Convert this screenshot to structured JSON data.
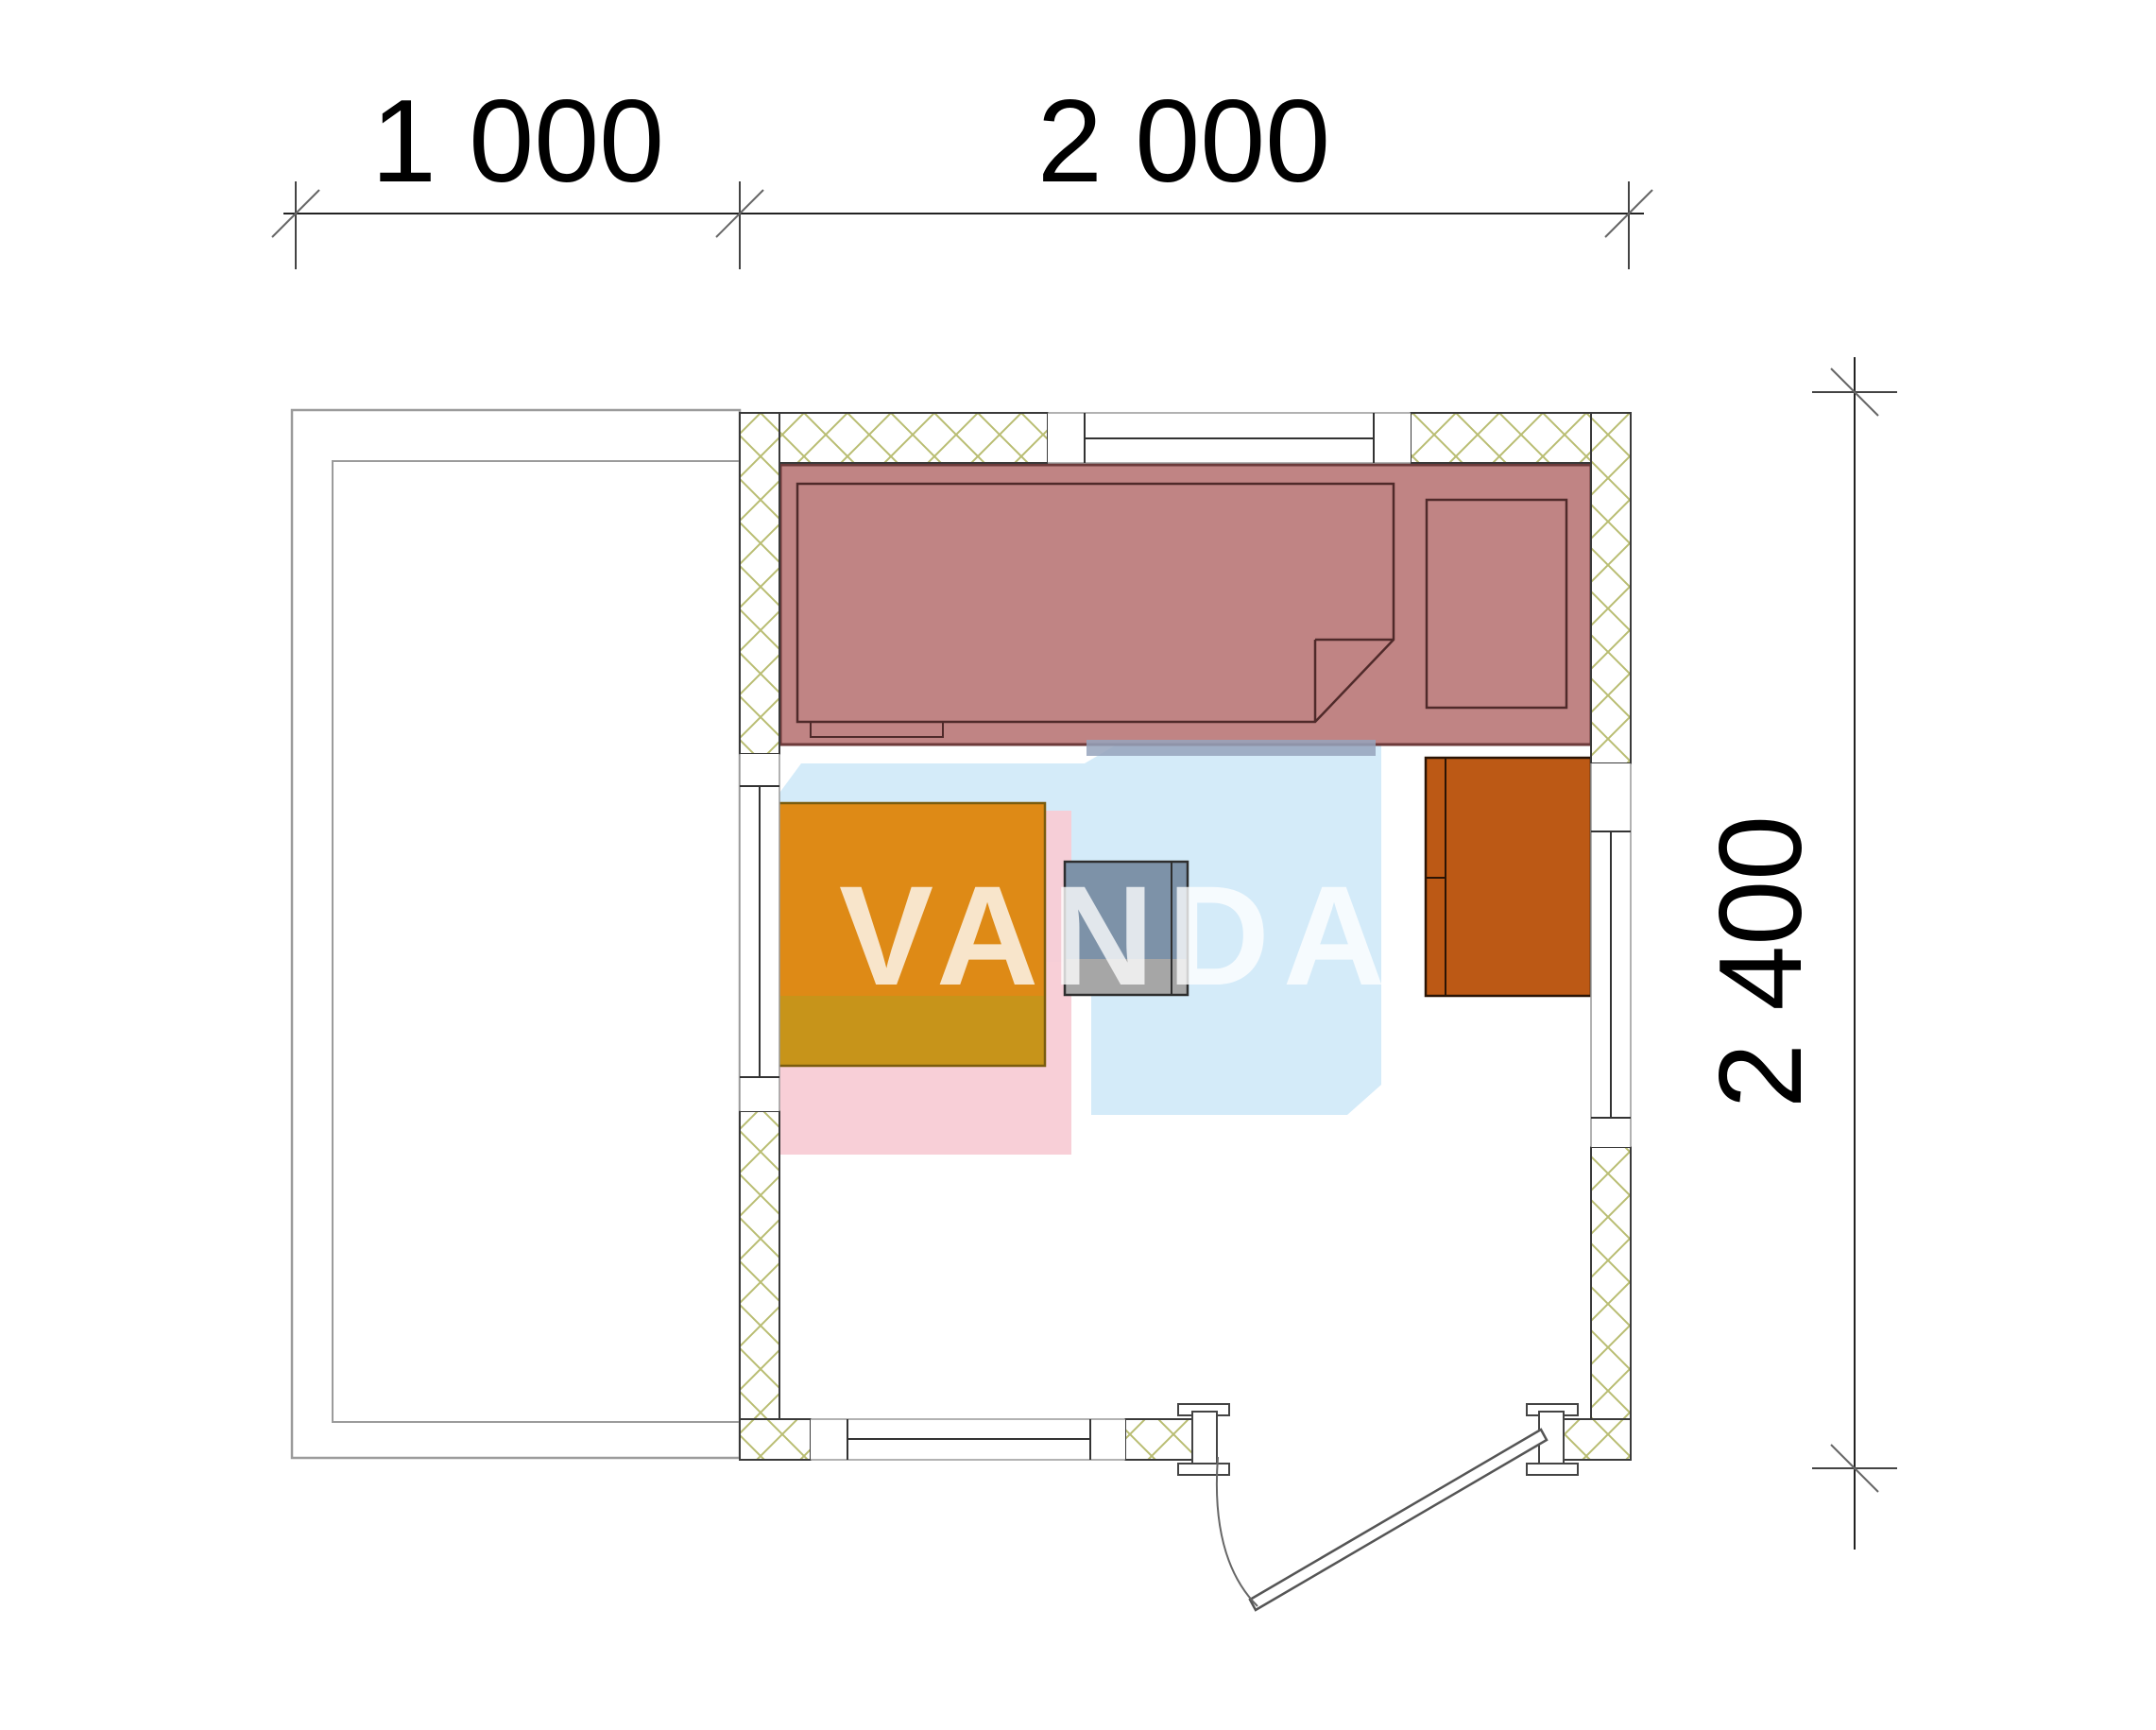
{
  "dimensions": {
    "top_segment_1": "1 000",
    "top_segment_2": "2 000",
    "right_segment": "2 400"
  },
  "watermark": {
    "text": "VANDA"
  },
  "colors": {
    "hatch": "#b9bd72",
    "wall_outline": "#3a3a3a",
    "terrace_outline": "#9b9b9b",
    "bench_fill": "#c08484",
    "bench_outline": "#6d3a3a",
    "bench_inner_line": "#4f2a2a",
    "table_top": "#de8a16",
    "table_bottom": "#c7941a",
    "table_outline": "#7a5c0e",
    "stove_top": "#7d92a8",
    "stove_bottom": "#a6a6a6",
    "stove_outline": "#2e2e2e",
    "heater": "#bc5915",
    "heater_outline": "#2a1405",
    "watermark_blue": "#cfe9f8",
    "watermark_pink": "#f8ccd5",
    "watermark_strip": "#95a3bc",
    "dimension_text": "#000000"
  }
}
